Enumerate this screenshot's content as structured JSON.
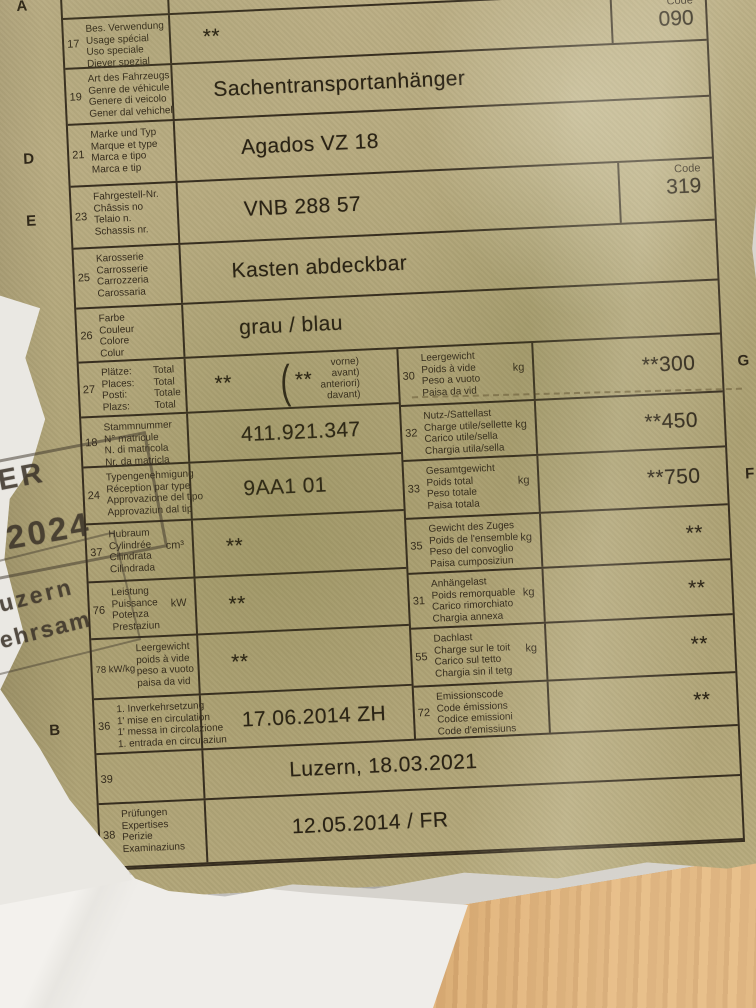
{
  "document": {
    "type_note": "Swiss vehicle registration card (photographed)",
    "code_label": "Code",
    "rows_full": [
      {
        "number": "15",
        "margin_letter": "A",
        "labels": [
          "Targa",
          "Numer"
        ],
        "value": ""
      },
      {
        "number": "17",
        "labels": [
          "Bes. Verwendung",
          "Usage spécial",
          "Uso speciale",
          "Diever spezial"
        ],
        "value": "**",
        "code": "090"
      },
      {
        "number": "19",
        "labels": [
          "Art des Fahrzeugs",
          "Genre de véhicule",
          "Genere di veicolo",
          "Gener dal vehichel"
        ],
        "value": "Sachentransportanhänger"
      },
      {
        "number": "21",
        "margin_letter": "D",
        "labels": [
          "Marke und Typ",
          "Marque et type",
          "Marca e tipo",
          "Marca e tip"
        ],
        "value": "Agados VZ 18"
      },
      {
        "number": "23",
        "margin_letter": "E",
        "labels": [
          "Fahrgestell-Nr.",
          "Châssis no",
          "Telaio n.",
          "Schassis nr."
        ],
        "value": "VNB 288 57",
        "code": "319"
      },
      {
        "number": "25",
        "labels": [
          "Karosserie",
          "Carrosserie",
          "Carrozzeria",
          "Carossaria"
        ],
        "value": "Kasten abdeckbar"
      },
      {
        "number": "26",
        "labels": [
          "Farbe",
          "Couleur",
          "Colore",
          "Colur"
        ],
        "value": "grau / blau"
      }
    ],
    "split": {
      "left": [
        {
          "number": "27",
          "labels": [
            "Plätze:",
            "Places:",
            "Posti:",
            "Plazs:"
          ],
          "labels2": [
            "Total",
            "Total",
            "Totale",
            "Total"
          ],
          "value": "**",
          "front_value": "**",
          "front_labels": [
            "vorne)",
            "avant)",
            "anteriori)",
            "davant)"
          ]
        },
        {
          "number": "18",
          "labels": [
            "Stammnummer",
            "N° matricule",
            "N. di matricola",
            "Nr. da matricla"
          ],
          "value": "411.921.347"
        },
        {
          "number": "24",
          "labels": [
            "Typengenehmigung",
            "Réception par type",
            "Approvazione del tipo",
            "Approvaziun dal tip"
          ],
          "value": "9AA1 01"
        },
        {
          "number": "37",
          "labels": [
            "Hubraum",
            "Cylindrée",
            "Cilindrata",
            "Cilindrada"
          ],
          "unit": "cm³",
          "value": "**"
        },
        {
          "number": "76",
          "labels": [
            "Leistung",
            "Puissance",
            "Potenza",
            "Prestaziun"
          ],
          "unit": "kW",
          "value": "**"
        },
        {
          "number": "78 kW/kg",
          "indent": true,
          "labels": [
            "Leergewicht",
            "poids à vide",
            "peso a vuoto",
            "paisa da vid"
          ],
          "value": "**"
        },
        {
          "number": "36",
          "margin_letter": "B",
          "labels": [
            "1. Inverkehrsetzung",
            "1' mise en circulation",
            "1' messa in circolazione",
            "1. entrada en circulaziun"
          ],
          "value": "17.06.2014 ZH"
        }
      ],
      "right": [
        {
          "number": "30",
          "margin_letter": "G",
          "labels": [
            "Leergewicht",
            "Poids à vide",
            "Peso a vuoto",
            "Paisa da vid"
          ],
          "unit": "kg",
          "value": "**300"
        },
        {
          "number": "32",
          "labels": [
            "Nutz-/Sattellast",
            "Charge utile/sellette",
            "Carico utile/sella",
            "Chargia utila/sella"
          ],
          "unit": "kg",
          "value": "**450"
        },
        {
          "number": "33",
          "margin_letter": "F",
          "labels": [
            "Gesamtgewicht",
            "Poids total",
            "Peso totale",
            "Paisa totala"
          ],
          "unit": "kg",
          "value": "**750"
        },
        {
          "number": "35",
          "labels": [
            "Gewicht des Zuges",
            "Poids de l'ensemble",
            "Peso del convoglio",
            "Paisa cumposiziun"
          ],
          "unit": "kg",
          "value": "**"
        },
        {
          "number": "31",
          "labels": [
            "Anhängelast",
            "Poids remorquable",
            "Carico rimorchiato",
            "Chargia annexa"
          ],
          "unit": "kg",
          "value": "**"
        },
        {
          "number": "55",
          "labels": [
            "Dachlast",
            "Charge sur le toit",
            "Carico sul tetto",
            "Chargia sin il tetg"
          ],
          "unit": "kg",
          "value": "**"
        },
        {
          "number": "72",
          "labels": [
            "Emissionscode",
            "Code émissions",
            "Codice emissioni",
            "Code d'emissiuns"
          ],
          "value": "**"
        }
      ]
    },
    "bottom_rows": [
      {
        "number": "39",
        "labels": [],
        "value": "Luzern, 18.03.2021"
      },
      {
        "number": "38",
        "labels": [
          "Prüfungen",
          "Expertises",
          "Perizie",
          "Examinaziuns"
        ],
        "value": "12.05.2014 / FR"
      }
    ],
    "stamp": {
      "fragment_1": "IER",
      "fragment_2": "2024",
      "fragment_3": "uzern",
      "fragment_4": "kehrsam"
    },
    "colors": {
      "paper": "#b2a77b",
      "ink": "#2d2418",
      "stamp_ink": "#3a3228",
      "wood": "#cf9a5e",
      "background_paper": "#efede9"
    }
  }
}
